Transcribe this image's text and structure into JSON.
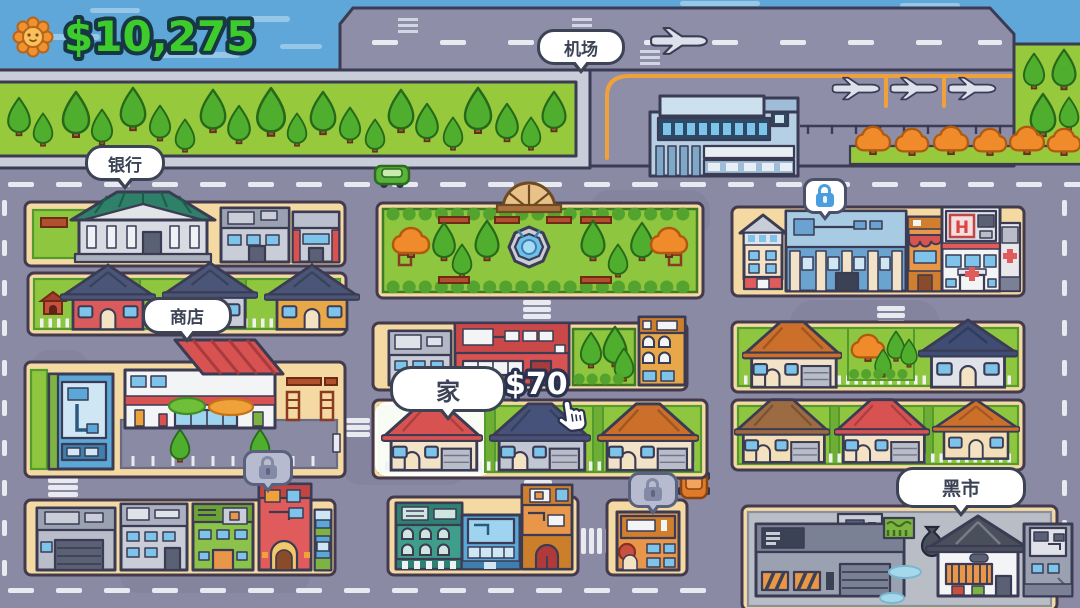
{
  "hud": {
    "money": "$10,275",
    "coin_icon": "sunflower-coin-icon"
  },
  "map_labels": {
    "airport": "机场",
    "bank": "银行",
    "shop": "商店",
    "home": "家",
    "black_market": "黑市"
  },
  "price_tags": {
    "home": "$70"
  },
  "signs": {
    "hospital": "H"
  },
  "locks": {
    "hospital_district": "locked-blue",
    "southwest_block": "locked-gray",
    "south_small_block": "locked-gray"
  },
  "colors": {
    "money_green": "#3ecb2c",
    "sky_blue": "#5ea7d8",
    "road_gray": "#8a8aa4",
    "block_tan": "#f4d9a2",
    "grass_green": "#97c93d",
    "bubble_outline": "#3b4354",
    "lock_blue": "#4a9edd",
    "lock_gray_bubble": "#b6bbcf",
    "highlight_white": "#ffffff"
  }
}
